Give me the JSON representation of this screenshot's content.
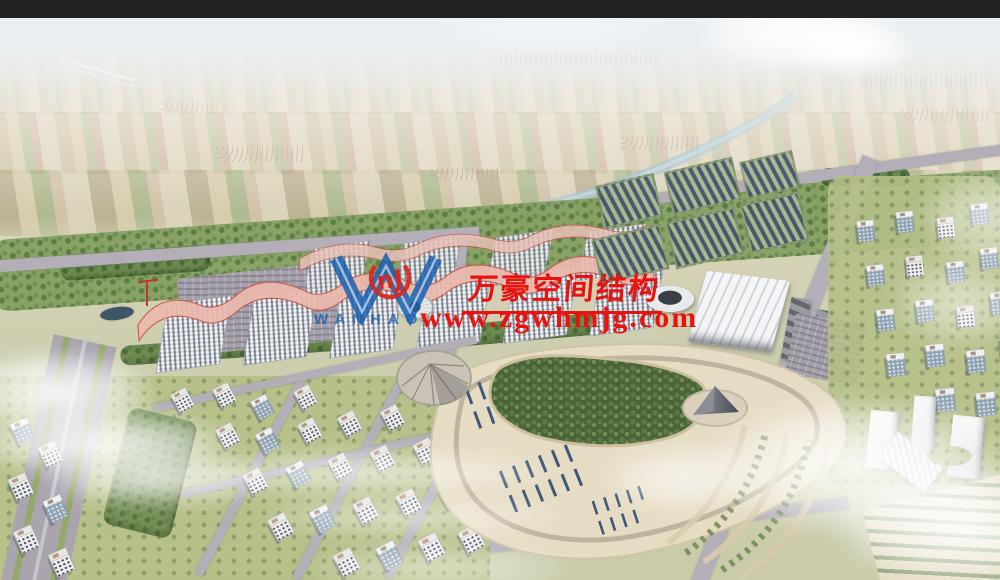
{
  "image_type": "aerial-architectural-rendering",
  "watermark": {
    "company_name_cn": "万豪空间结构",
    "website": "www.zgwhmjg.com",
    "logo": {
      "wordmark": "WANHAO",
      "mark_text": "nJ"
    },
    "colors": {
      "text_red": "#e8120e",
      "logo_blue": "#1a5fb0",
      "mark_red": "#d6281e"
    }
  },
  "scene": {
    "palette": {
      "sky_haze": "#e9e8e0",
      "farmland_tan": "#d6cdae",
      "farmland_green": "#8ea86c",
      "river_blue": "#8fb8cf",
      "vegetation_green": "#6d8a4f",
      "road_gray": "#b3aeb8",
      "hall_facade_white": "#eef0f3",
      "hall_roof_pink": "#ecb9ad",
      "hall_roof_red": "#c4574a",
      "solar_panel_blue": "#3c5878",
      "plaza_sand": "#e6dcc3",
      "forest_green": "#4a6338",
      "building_white": "#f0f0f1",
      "glass_facade_blue": "#8fa2b0",
      "cloud_white": "#ffffff"
    }
  }
}
